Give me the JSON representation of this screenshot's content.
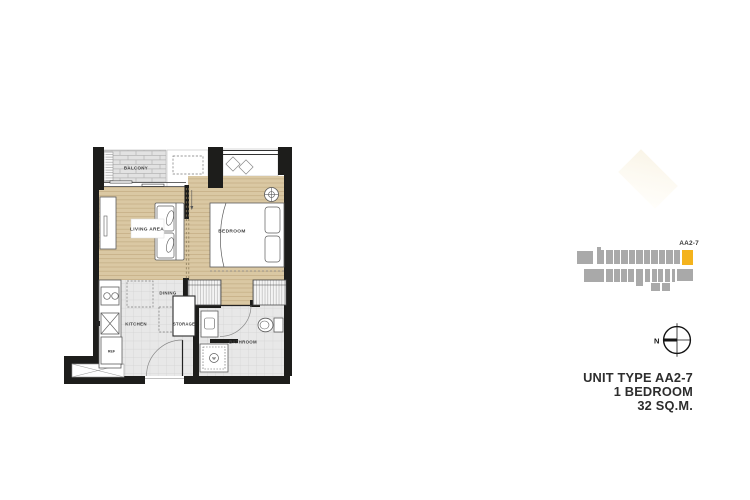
{
  "floorplan": {
    "labels": {
      "balcony": "BALCONY",
      "living_area": "LIVING AREA",
      "bedroom": "BEDROOM",
      "dining": "DINING",
      "kitchen": "KITCHEN",
      "storage": "STORAGE",
      "bathroom": "BATHROOM",
      "refrigerator": "REF",
      "washer": "W"
    },
    "colors": {
      "wall": "#1d1d1b",
      "wood_floor": "#dac8a3",
      "wood_line": "#c6b087",
      "tile_floor": "#e8e8e8",
      "tile_line": "#d2d2d2",
      "furniture_line": "#5c5c5c"
    }
  },
  "keyplan": {
    "unit_label": "AA2-7",
    "block_color": "#a9a9a9",
    "highlight_color": "#f4b31d",
    "blocks": [
      [
        2,
        8,
        16,
        13
      ],
      [
        22,
        4,
        4,
        4
      ],
      [
        22,
        7,
        7,
        14
      ],
      [
        31,
        7,
        6.5,
        14
      ],
      [
        38.5,
        7,
        6.5,
        14
      ],
      [
        46,
        7,
        6.5,
        14
      ],
      [
        53.5,
        7,
        6.5,
        14
      ],
      [
        61,
        7,
        6.5,
        14
      ],
      [
        68.5,
        7,
        6.5,
        14
      ],
      [
        76,
        7,
        6.5,
        14
      ],
      [
        83.5,
        7,
        6.5,
        14
      ],
      [
        91,
        7,
        6.5,
        14
      ],
      [
        98.5,
        7,
        6.8,
        14
      ],
      [
        9,
        26,
        20,
        13
      ],
      [
        31,
        26,
        6.5,
        13
      ],
      [
        38.5,
        26,
        6,
        13
      ],
      [
        45.5,
        26,
        6.5,
        13
      ],
      [
        53,
        26,
        6,
        13
      ],
      [
        60.5,
        26,
        7,
        17
      ],
      [
        69.5,
        26,
        5.5,
        13
      ],
      [
        76.5,
        26,
        5,
        13
      ],
      [
        83,
        26,
        5,
        13
      ],
      [
        89.5,
        26,
        5.5,
        13
      ],
      [
        96.5,
        26,
        3.5,
        13
      ],
      [
        101.5,
        26,
        16,
        12
      ],
      [
        76,
        39.5,
        9,
        8
      ],
      [
        87,
        39.5,
        8,
        8
      ]
    ],
    "unit_block": [
      106.5,
      7,
      11,
      14.5
    ]
  },
  "compass": {
    "north_label": "N"
  },
  "info": {
    "line1": "UNIT TYPE AA2-7",
    "line2": "1 BEDROOM",
    "line3": "32 SQ.M."
  }
}
